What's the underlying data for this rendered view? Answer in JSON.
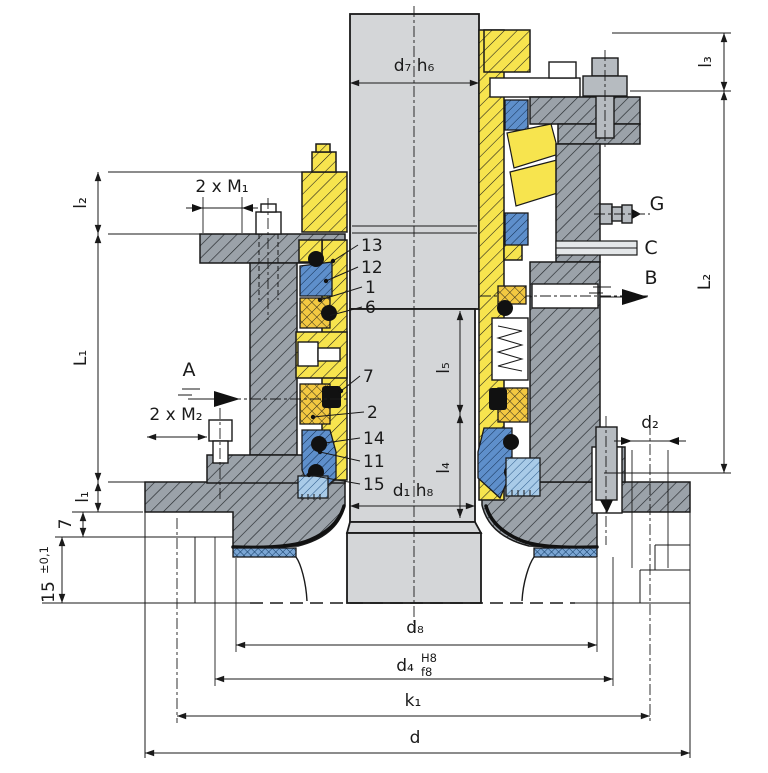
{
  "drawing": {
    "kind": "sectional-technical-drawing-mechanical-seal",
    "dimensions": {
      "d7": "d₇ h₆",
      "l3": "l₃",
      "l2": "l₂",
      "L1": "L₁",
      "L2": "L₂",
      "l1": "l₁",
      "seven": "7",
      "fifteen": "15",
      "fifteen_tol": "±0,1",
      "m1": "2 x M₁",
      "m2": "2 x M₂",
      "l5": "l₅",
      "l4": "l₄",
      "d1": "d₁ h₈",
      "d2": "d₂",
      "d8": "d₈",
      "d4": "d₄",
      "d4_upper": "H8",
      "d4_lower": "f8",
      "k1": "k₁",
      "d": "d"
    },
    "connections": {
      "A": "A",
      "B": "B",
      "C": "C",
      "G": "G"
    },
    "parts": {
      "p13": "13",
      "p12": "12",
      "p1": "1",
      "p6": "6",
      "p7": "7",
      "p2": "2",
      "p14": "14",
      "p11": "11",
      "p15": "15"
    },
    "colors": {
      "shaft_gray": "#d4d6d8",
      "housing_gray": "#9ba2a9",
      "sleeve_yellow": "#f7e44e",
      "packing_yellow": "#f3c841",
      "seal_blue": "#5e8fcb",
      "seat_blue_light": "#a9cbe8",
      "gasket_blue": "#7ba6d4",
      "line": "#1a1a1a"
    }
  }
}
